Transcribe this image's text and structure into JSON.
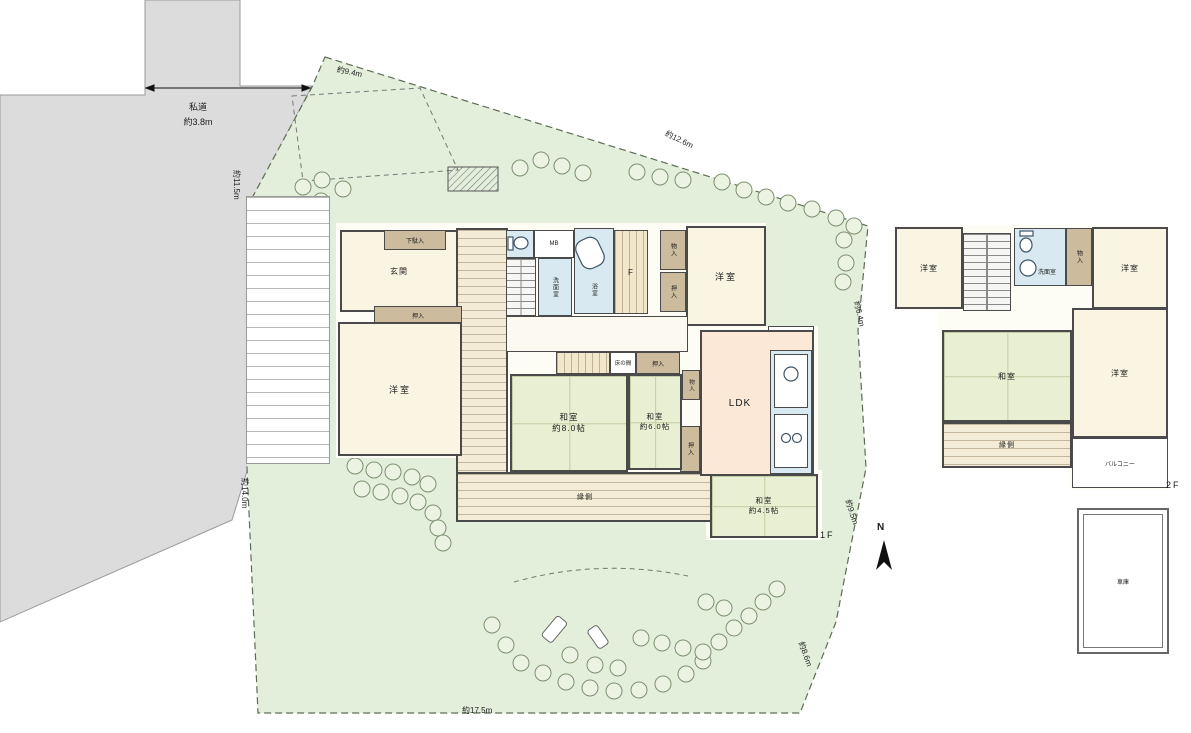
{
  "site": {
    "road": {
      "name": "私道",
      "width": "約3.8m"
    },
    "dims": {
      "top": "約9.4m",
      "top_right": "約12.6m",
      "left_upper": "約11.5m",
      "left_lower": "約14.0m",
      "right_upper": "約6.4m",
      "right_lower": "約9.5m",
      "bottom": "約17.5m",
      "bottom_right": "約8.6m"
    },
    "north": "N",
    "trees": [
      [
        303,
        187
      ],
      [
        322,
        180
      ],
      [
        343,
        189
      ],
      [
        300,
        207
      ],
      [
        321,
        201
      ],
      [
        520,
        168
      ],
      [
        541,
        160
      ],
      [
        562,
        166
      ],
      [
        583,
        173
      ],
      [
        637,
        172
      ],
      [
        660,
        177
      ],
      [
        683,
        180
      ],
      [
        722,
        182
      ],
      [
        744,
        190
      ],
      [
        766,
        197
      ],
      [
        788,
        203
      ],
      [
        812,
        209
      ],
      [
        836,
        218
      ],
      [
        854,
        226
      ],
      [
        844,
        240
      ],
      [
        846,
        263
      ],
      [
        843,
        282
      ],
      [
        355,
        466
      ],
      [
        374,
        470
      ],
      [
        393,
        472
      ],
      [
        412,
        477
      ],
      [
        428,
        484
      ],
      [
        362,
        489
      ],
      [
        381,
        492
      ],
      [
        400,
        496
      ],
      [
        418,
        502
      ],
      [
        433,
        513
      ],
      [
        438,
        528
      ],
      [
        443,
        543
      ],
      [
        492,
        625
      ],
      [
        506,
        645
      ],
      [
        521,
        663
      ],
      [
        543,
        673
      ],
      [
        566,
        682
      ],
      [
        590,
        688
      ],
      [
        614,
        691
      ],
      [
        639,
        690
      ],
      [
        663,
        684
      ],
      [
        686,
        674
      ],
      [
        703,
        661
      ],
      [
        641,
        638
      ],
      [
        662,
        643
      ],
      [
        683,
        648
      ],
      [
        703,
        652
      ],
      [
        719,
        642
      ],
      [
        734,
        628
      ],
      [
        749,
        616
      ],
      [
        763,
        602
      ],
      [
        777,
        589
      ],
      [
        706,
        602
      ],
      [
        724,
        608
      ],
      [
        618,
        668
      ],
      [
        595,
        665
      ],
      [
        570,
        655
      ]
    ]
  },
  "f1": {
    "floor_label": "1F",
    "genkan": "玄関",
    "getabako": "下駄入",
    "mb": "MB",
    "washroom": "洗面室",
    "bath": "浴室",
    "free_room": "F",
    "storage_a": "物入",
    "closet_a": "押入",
    "western_ne": "洋室",
    "kitchen_door": "勝手口",
    "ldk": "LDK",
    "tokonoma": "床の間",
    "closet_b": "押入",
    "storage_b": "物入",
    "closet_c": "押入",
    "washitsu8": {
      "name": "和室",
      "size": "約8.0帖"
    },
    "washitsu6": {
      "name": "和室",
      "size": "約6.0帖"
    },
    "washitsu45": {
      "name": "和室",
      "size": "約4.5帖"
    },
    "western_w": "洋室",
    "closet_w": "押入",
    "engawa": "縁側"
  },
  "f2": {
    "floor_label": "2F",
    "western_nw": "洋室",
    "washroom": "洗面室",
    "storage": "物入",
    "western_ne": "洋室",
    "washitsu": "和室",
    "western_e": "洋室",
    "engawa": "縁側",
    "balcony": "バルコニー"
  },
  "garage": "車庫"
}
